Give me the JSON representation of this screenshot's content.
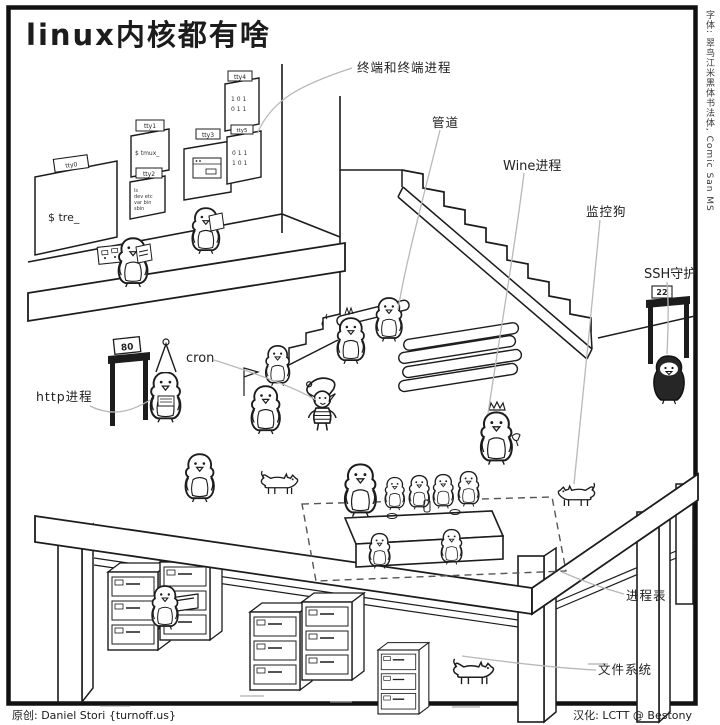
{
  "title": "linux内核都有啥",
  "side_note": "字体: 翠鸟江米黑体书法体, Comic San MS",
  "credits": {
    "author": "原创: Daniel Stori {turnoff.us}",
    "translator": "汉化: LCTT @ Bestony"
  },
  "callouts": {
    "terminals": "终端和终端进程",
    "pipe": "管道",
    "wine": "Wine进程",
    "watchdog": "监控狗",
    "ssh": "SSH守护",
    "cron": "cron",
    "http": "http进程",
    "process_table": "进程表",
    "filesystem": "文件系统"
  },
  "signs": {
    "http_port": "80",
    "ssh_port": "22"
  },
  "posters": {
    "tags": [
      "tty0",
      "tty1",
      "tty2",
      "tty3",
      "tty4",
      "tty5"
    ],
    "screen_tre": "$ tre_",
    "screen_tmux": "$ tmux_",
    "listing": [
      "ls",
      "dev  etc",
      "var  bin",
      "sbin"
    ],
    "digits": [
      "1 0 1",
      "0 1 1"
    ]
  },
  "colors": {
    "ink": "#1c1c1c",
    "leader": "#b8b8b8",
    "paper": "#ffffff"
  }
}
